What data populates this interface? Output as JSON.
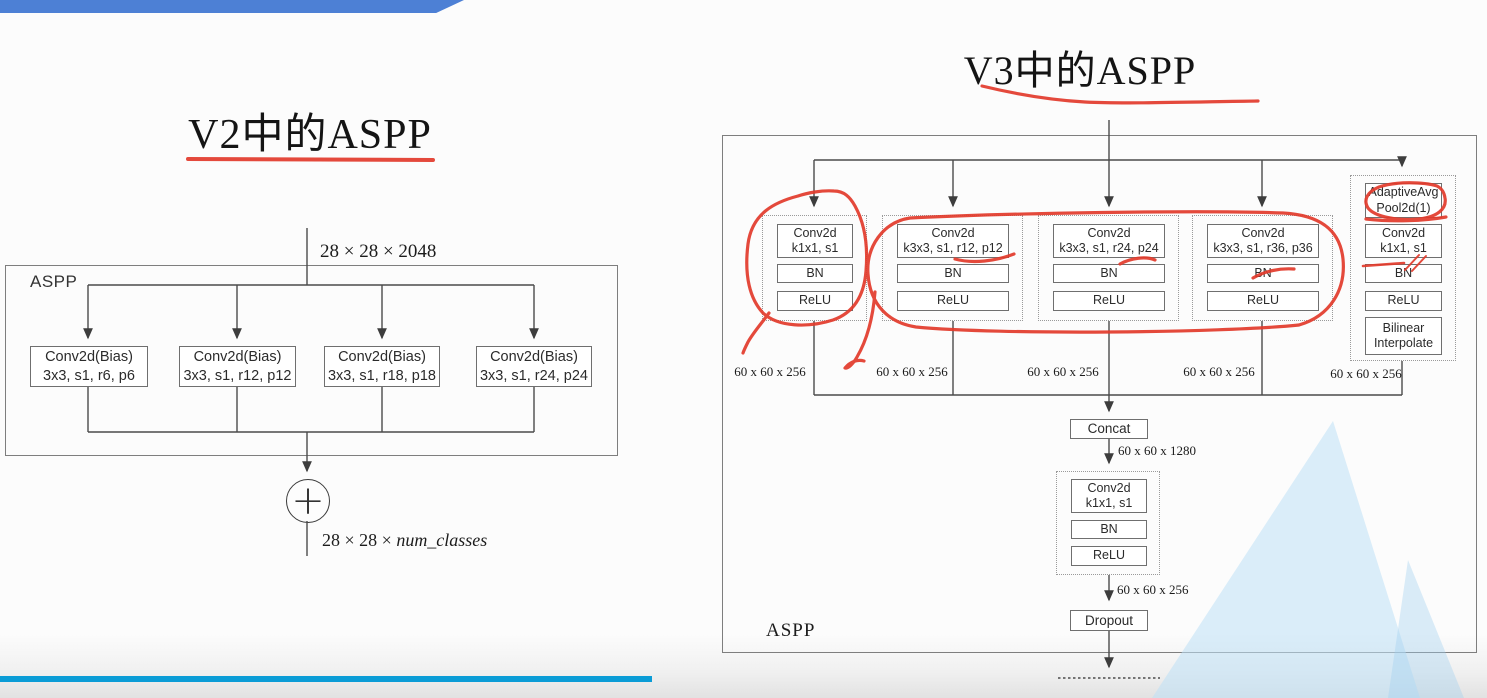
{
  "v2": {
    "title": "V2中的ASPP",
    "input_dim": "28 × 28 × 2048",
    "module_label": "ASPP",
    "branches": [
      {
        "l1": "Conv2d(Bias)",
        "l2": "3x3, s1, r6, p6"
      },
      {
        "l1": "Conv2d(Bias)",
        "l2": "3x3, s1, r12, p12"
      },
      {
        "l1": "Conv2d(Bias)",
        "l2": "3x3, s1, r18, p18"
      },
      {
        "l1": "Conv2d(Bias)",
        "l2": "3x3, s1, r24, p24"
      }
    ],
    "sum_symbol": "+",
    "output_dim_prefix": "28 × 28 × ",
    "output_dim_var": "num_classes"
  },
  "v3": {
    "title": "V3中的ASPP",
    "module_label": "ASPP",
    "branches": [
      {
        "boxes": [
          {
            "l1": "Conv2d",
            "l2": "k1x1, s1"
          },
          {
            "l1": "BN"
          },
          {
            "l1": "ReLU"
          }
        ],
        "output": "60 x 60 x 256"
      },
      {
        "boxes": [
          {
            "l1": "Conv2d",
            "l2": "k3x3, s1, r12, p12"
          },
          {
            "l1": "BN"
          },
          {
            "l1": "ReLU"
          }
        ],
        "output": "60 x 60 x 256"
      },
      {
        "boxes": [
          {
            "l1": "Conv2d",
            "l2": "k3x3, s1, r24, p24"
          },
          {
            "l1": "BN"
          },
          {
            "l1": "ReLU"
          }
        ],
        "output": "60 x 60 x 256"
      },
      {
        "boxes": [
          {
            "l1": "Conv2d",
            "l2": "k3x3, s1, r36, p36"
          },
          {
            "l1": "BN"
          },
          {
            "l1": "ReLU"
          }
        ],
        "output": "60 x 60 x 256"
      },
      {
        "boxes": [
          {
            "l1": "AdaptiveAvg",
            "l2": "Pool2d(1)"
          },
          {
            "l1": "Conv2d",
            "l2": "k1x1, s1"
          },
          {
            "l1": "BN"
          },
          {
            "l1": "ReLU"
          },
          {
            "l1": "Bilinear",
            "l2": "Interpolate"
          }
        ],
        "output": "60 x 60 x 256"
      }
    ],
    "concat_label": "Concat",
    "concat_output": "60 x 60 x 1280",
    "projection": {
      "boxes": [
        {
          "l1": "Conv2d",
          "l2": "k1x1, s1"
        },
        {
          "l1": "BN"
        },
        {
          "l1": "ReLU"
        }
      ]
    },
    "projection_output": "60 x 60 x 256",
    "dropout_label": "Dropout"
  },
  "colors": {
    "annotation_red": "#e23a2b",
    "banner_top": "#4d80d5",
    "banner_bottom": "#0a9cd6",
    "watermark_blue": "#bee0f5",
    "line_gray": "#4b4b4b"
  }
}
